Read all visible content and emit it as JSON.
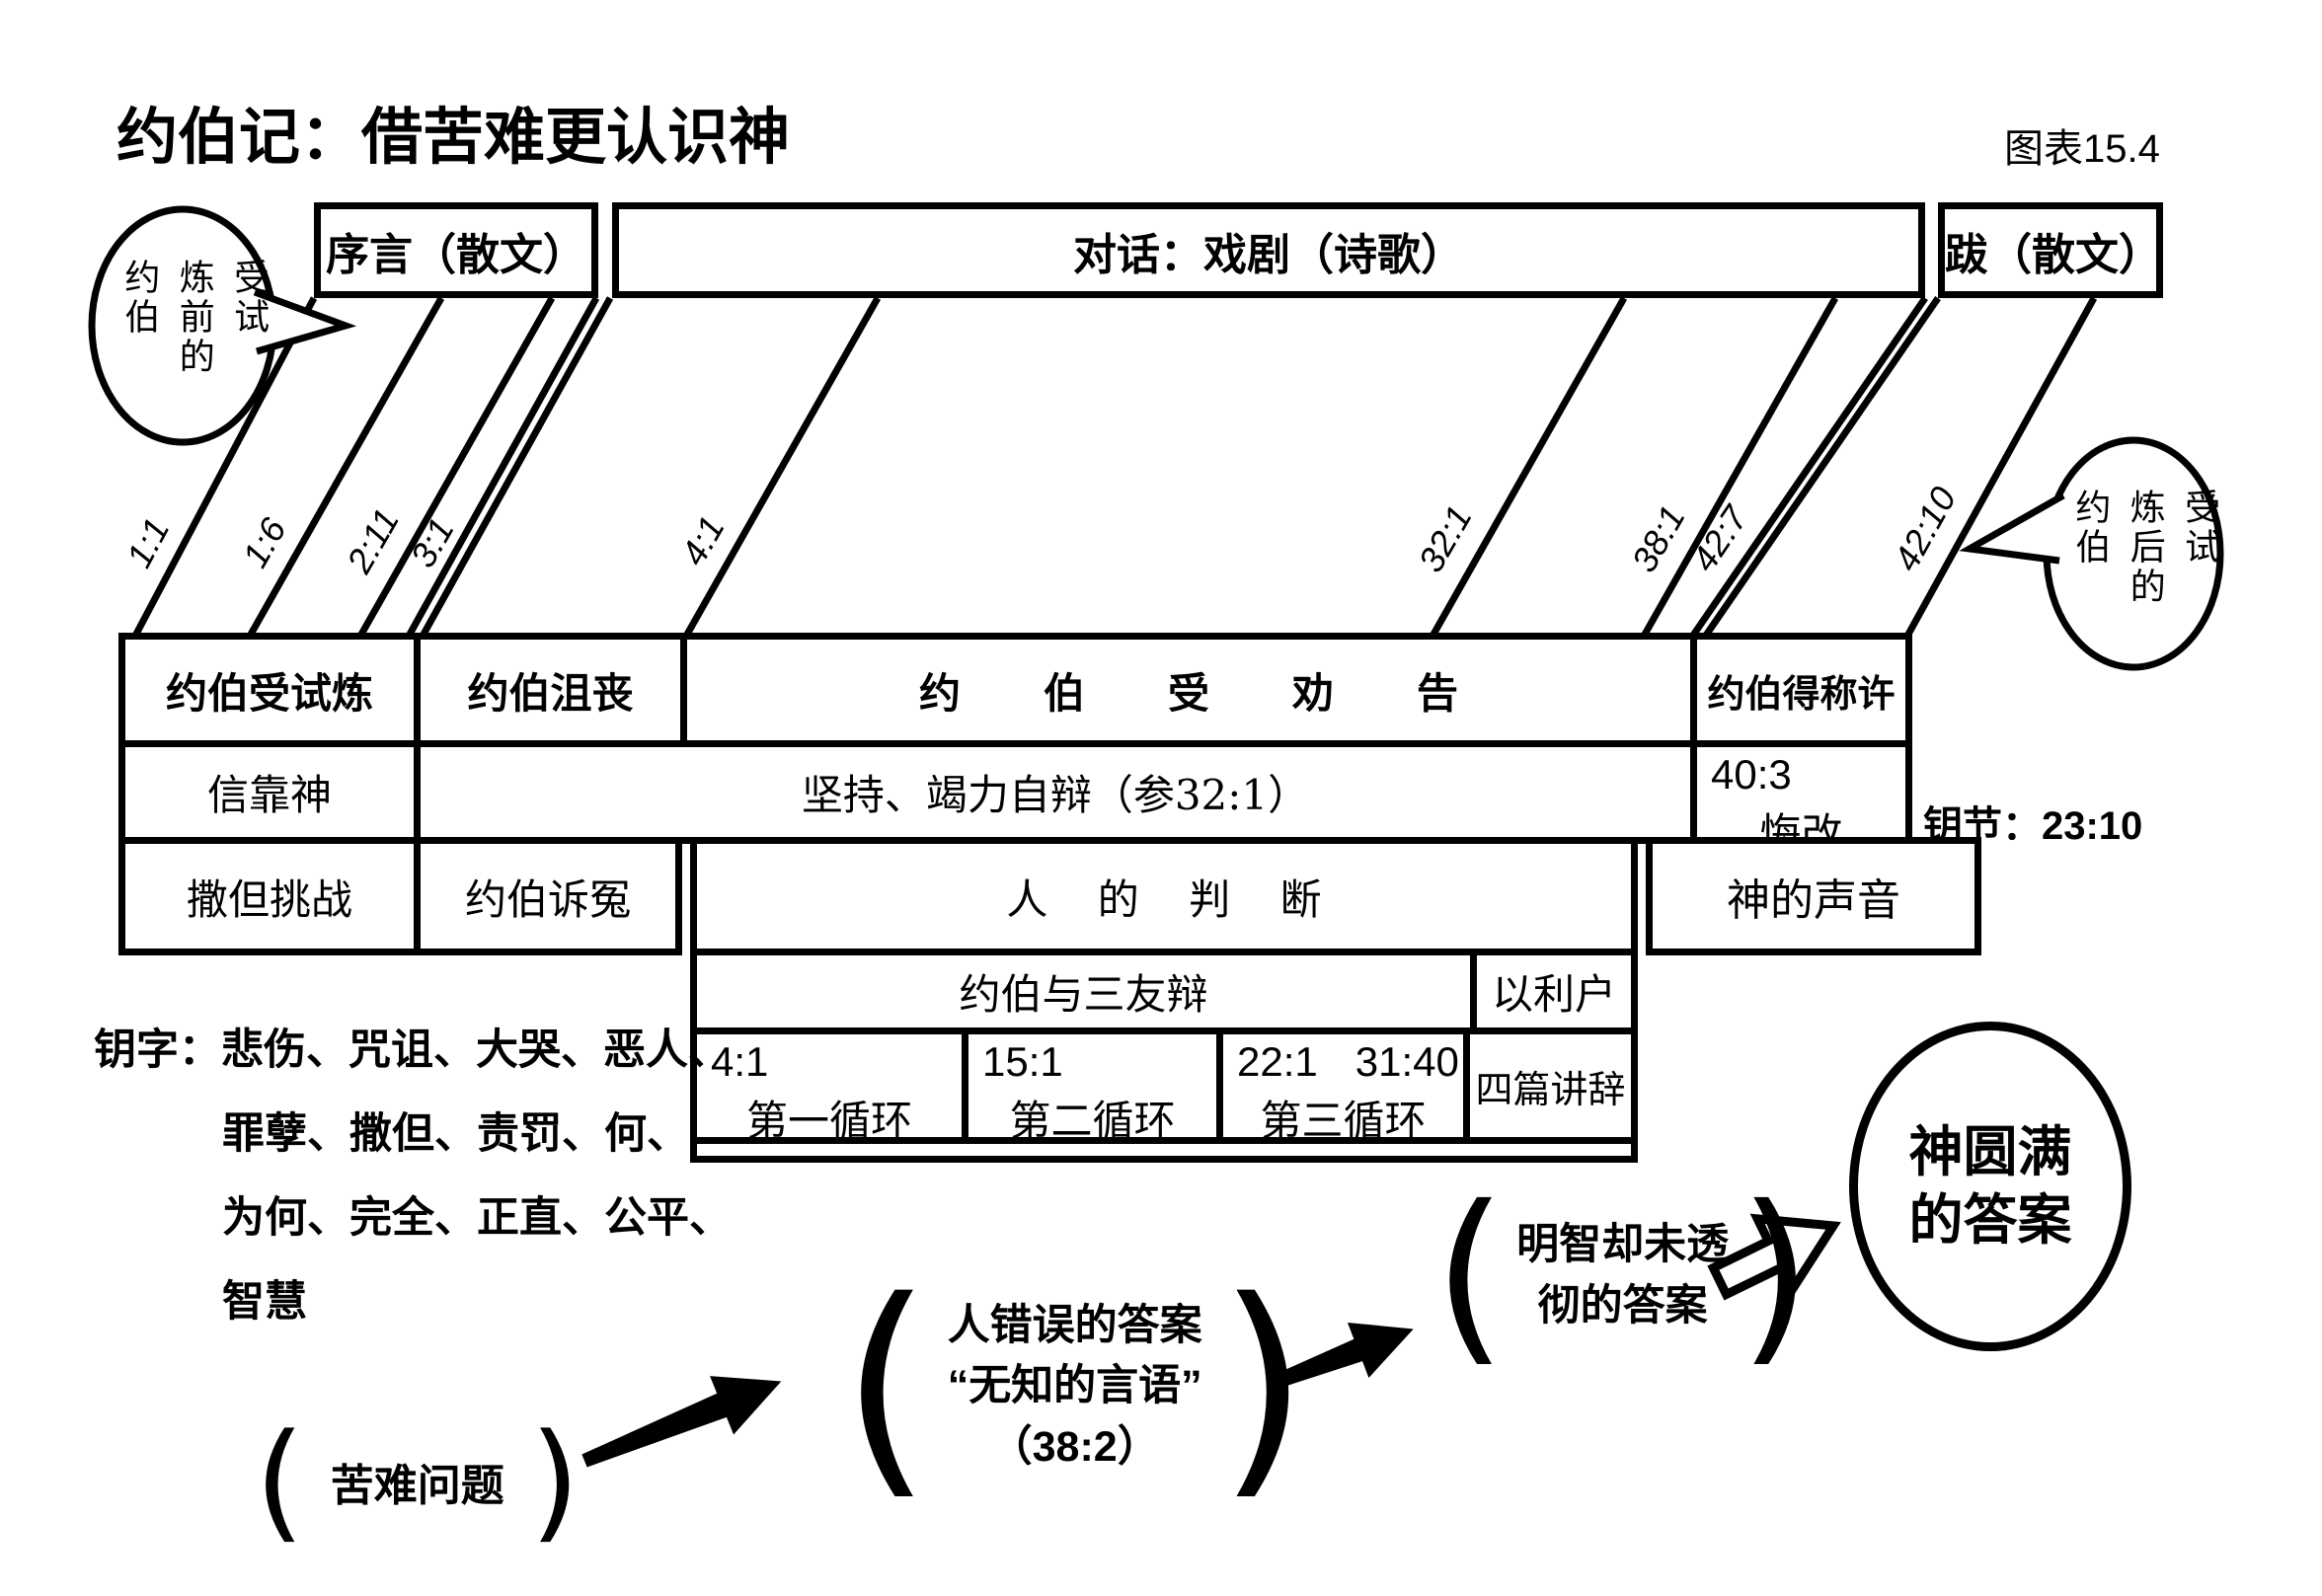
{
  "meta": {
    "title": "约伯记：借苦难更认识神",
    "figure_label": "图表15.4"
  },
  "top_band": {
    "prologue": "序言（散文）",
    "dialogue": "对话：戏剧（诗歌）",
    "epilogue": "跋（散文）"
  },
  "bubble_left": {
    "cols": [
      "约伯",
      "炼前的",
      "受试"
    ]
  },
  "bubble_right": {
    "cols": [
      "约伯",
      "炼后的",
      "受试"
    ]
  },
  "chapter_markers": [
    "1:1",
    "1:6",
    "2:11",
    "3:1",
    "4:1",
    "32:1",
    "38:1",
    "42:7",
    "42:10"
  ],
  "table": {
    "row1": [
      "约伯受试炼",
      "约伯沮丧",
      "约伯受劝告",
      "约伯得称许"
    ],
    "row2": {
      "trust": "信靠神",
      "persist": "坚持、竭力自辩（参32:1）",
      "repent_ref": "40:3",
      "repent": "悔改"
    },
    "key_verse": "钥节：23:10",
    "row3": {
      "satan": "撒但挑战",
      "complaint": "约伯诉冤",
      "judgment": "人的判断",
      "voice": "神的声音"
    },
    "debate": {
      "with_friends": "约伯与三友辩",
      "elihu": "以利户",
      "speeches": "四篇讲辞",
      "cycles": [
        {
          "ref": "4:1",
          "ref2": "",
          "label": "第一循环"
        },
        {
          "ref": "15:1",
          "ref2": "",
          "label": "第二循环"
        },
        {
          "ref": "22:1",
          "ref2": "31:40",
          "label": "第三循环"
        }
      ]
    }
  },
  "key_words": {
    "lines": [
      "钥字：悲伤、咒诅、大哭、恶人、",
      "罪孽、撒但、责罚、何、",
      "为何、完全、正直、公平、",
      "智慧"
    ]
  },
  "flow": {
    "problem": "苦难问题",
    "wrong_answer_lines": [
      "人错误的答案",
      "“无知的言语”",
      "（38:2）"
    ],
    "partial_answer_lines": [
      "明智却未透",
      "彻的答案"
    ],
    "full_answer_lines": [
      "神圆满",
      "的答案"
    ]
  }
}
